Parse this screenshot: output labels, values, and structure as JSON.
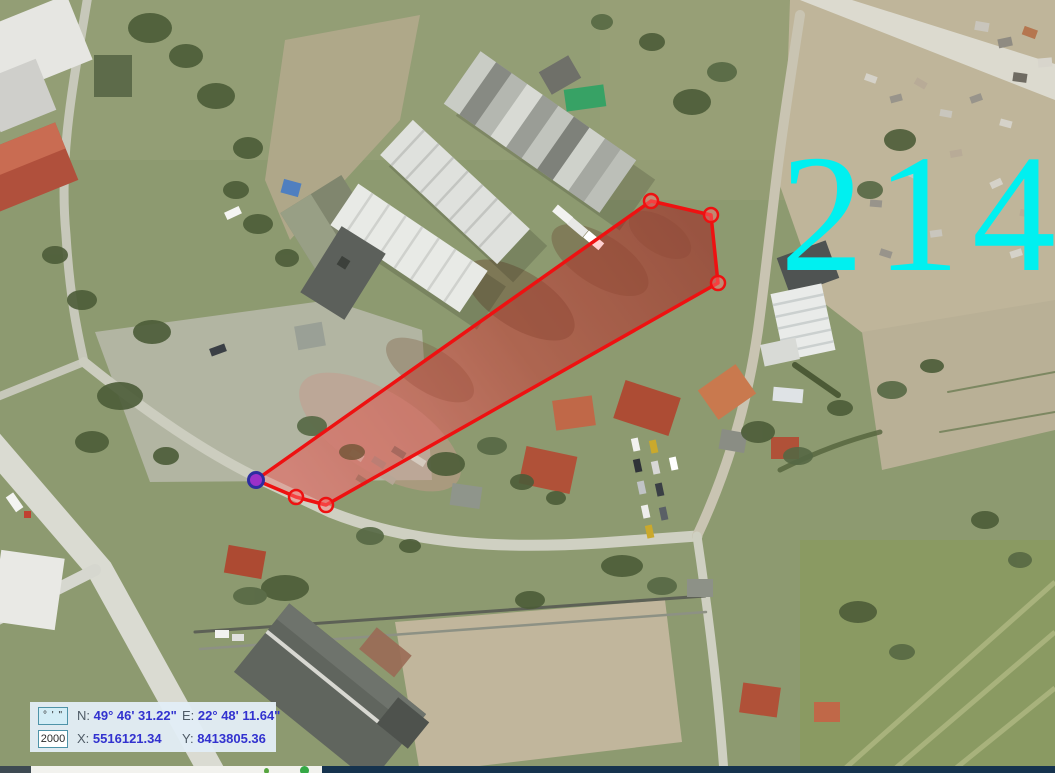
{
  "map": {
    "parcel_label": "214",
    "parcel_label_color": "#00f0f0",
    "polygon": {
      "stroke_color": "#ee1111",
      "stroke_width": 3.5,
      "fill_color": "rgba(255,40,40,0.22)",
      "vertices": [
        [
          651,
          201
        ],
        [
          711,
          215
        ],
        [
          718,
          283
        ],
        [
          326,
          505
        ],
        [
          296,
          497
        ],
        [
          256,
          480
        ]
      ],
      "vertex_radius": 7,
      "vertex_fill": "rgba(255,120,120,0.45)",
      "selected_vertex_index": 5,
      "selected_vertex_fill": "#9b30c8",
      "selected_vertex_stroke": "#2d2da0"
    }
  },
  "status_panel": {
    "dms_button_label": "° ' \"",
    "scale_value": "2000",
    "row1": {
      "lat_label": "N:",
      "lat_value": "49° 46' 31.22\"",
      "lon_label": "E:",
      "lon_value": "22° 48' 11.64\""
    },
    "row2": {
      "x_label": "X:",
      "x_value": "5516121.34",
      "y_label": "Y:",
      "y_value": "8413805.36"
    },
    "value_color": "#3232cf",
    "label_color": "#4f5b66"
  },
  "taskbar": {
    "start_segment_color": "#3e4a52",
    "app_segment_color": "#f2f2ee",
    "main_segment_color": "#16334e",
    "app_icon_color": "#35a845"
  }
}
